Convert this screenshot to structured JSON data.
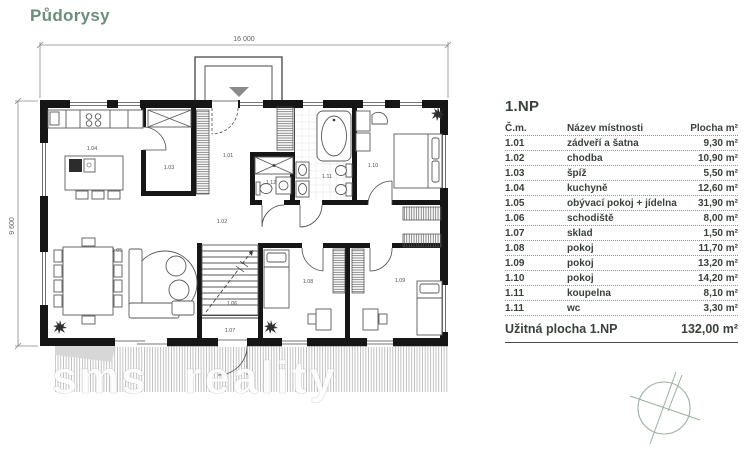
{
  "page": {
    "title": "Půdorysy"
  },
  "watermark": {
    "part1": "sms",
    "part2": "reality"
  },
  "plan": {
    "dim_width": "16 000",
    "dim_height": "9 600",
    "room_labels": [
      {
        "id": "1.04",
        "x": 92,
        "y": 150
      },
      {
        "id": "1.03",
        "x": 169,
        "y": 169
      },
      {
        "id": "1.01",
        "x": 228,
        "y": 157
      },
      {
        "id": "1.12",
        "x": 271,
        "y": 184
      },
      {
        "id": "1.11",
        "x": 327,
        "y": 178
      },
      {
        "id": "1.10",
        "x": 373,
        "y": 167
      },
      {
        "id": "1.02",
        "x": 222,
        "y": 223
      },
      {
        "id": "1.05",
        "x": 117,
        "y": 252
      },
      {
        "id": "1.06",
        "x": 232,
        "y": 305
      },
      {
        "id": "1.07",
        "x": 230,
        "y": 332
      },
      {
        "id": "1.08",
        "x": 308,
        "y": 283
      },
      {
        "id": "1.09",
        "x": 400,
        "y": 282
      }
    ]
  },
  "table": {
    "title": "1.NP",
    "columns": {
      "no": "Č.m.",
      "name": "Název místnosti",
      "area": "Plocha m²"
    },
    "rows": [
      {
        "no": "1.01",
        "name": "zádveří a šatna",
        "area": "9,30 m²"
      },
      {
        "no": "1.02",
        "name": "chodba",
        "area": "10,90 m²"
      },
      {
        "no": "1.03",
        "name": "špíž",
        "area": "5,50 m²"
      },
      {
        "no": "1.04",
        "name": "kuchyně",
        "area": "12,60 m²"
      },
      {
        "no": "1.05",
        "name": "obývací pokoj + jídelna",
        "area": "31,90 m²"
      },
      {
        "no": "1.06",
        "name": "schodiště",
        "area": "8,00 m²"
      },
      {
        "no": "1.07",
        "name": "sklad",
        "area": "1,50 m²"
      },
      {
        "no": "1.08",
        "name": "pokoj",
        "area": "11,70 m²"
      },
      {
        "no": "1.09",
        "name": "pokoj",
        "area": "13,20 m²"
      },
      {
        "no": "1.10",
        "name": "pokoj",
        "area": "14,20 m²"
      },
      {
        "no": "1.11",
        "name": "koupelna",
        "area": "8,10 m²"
      },
      {
        "no": "1.11",
        "name": "wc",
        "area": "3,30 m²"
      }
    ],
    "total_label": "Užitná plocha 1.NP",
    "total_value": "132,00 m²"
  },
  "colors": {
    "accent_green": "#6a8f79",
    "table_text": "#39413a",
    "wall_black": "#161616"
  }
}
